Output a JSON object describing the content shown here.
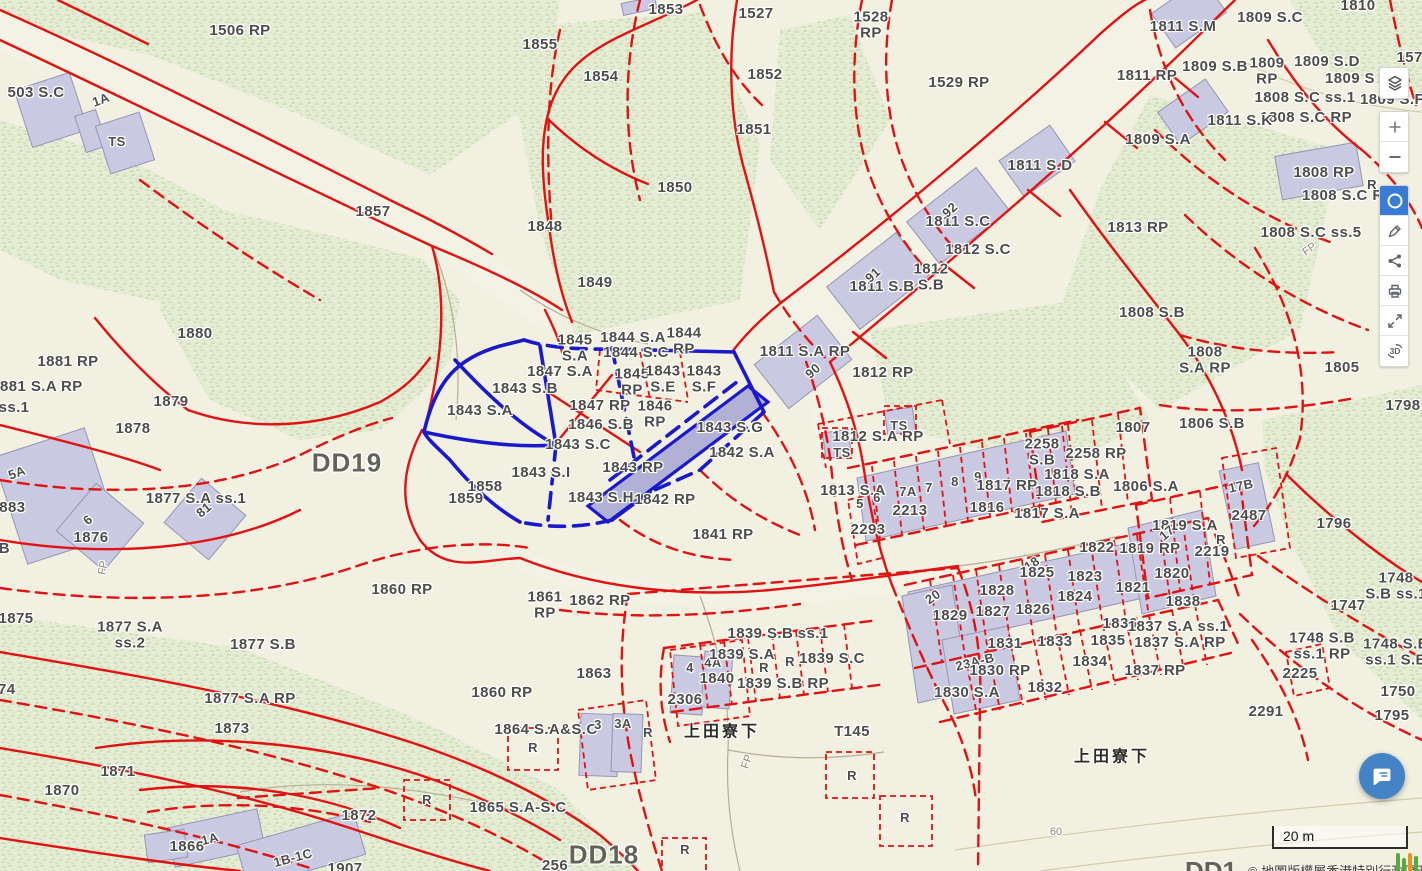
{
  "app": {
    "type": "cadastral-map-viewer"
  },
  "colors": {
    "boundary_red": "#e11212",
    "highlight_blue": "#1a1acb",
    "building_fill": "#c9c9e2",
    "vegetation": "#e6edd6",
    "background": "#f2f0e1",
    "active_tool": "#3a7bd5",
    "chat_fab": "#4484c6"
  },
  "toolbar": {
    "buttons": [
      {
        "name": "layers",
        "icon": "layers-icon",
        "active": false
      },
      {
        "name": "zoom-in",
        "icon": "plus-icon",
        "active": false
      },
      {
        "name": "zoom-out",
        "icon": "minus-icon",
        "active": false
      },
      {
        "name": "circle-select",
        "icon": "circle-icon",
        "active": true
      },
      {
        "name": "measure",
        "icon": "pencil-icon",
        "active": false
      },
      {
        "name": "share",
        "icon": "share-icon",
        "active": false
      },
      {
        "name": "print",
        "icon": "printer-icon",
        "active": false
      },
      {
        "name": "fullscreen",
        "icon": "expand-icon",
        "active": false
      },
      {
        "name": "3d-view",
        "icon": "3d-icon",
        "active": false
      }
    ],
    "threed_glyph": "3D"
  },
  "scalebar": {
    "label": "20 m"
  },
  "attribution": {
    "partial_label": "DD1",
    "text": "© 地圖版權屬香港特別行政區政府"
  },
  "map": {
    "labels": [
      {
        "t": "1506 RP",
        "x": 240,
        "y": 31
      },
      {
        "t": "503 S.C",
        "x": 36,
        "y": 93
      },
      {
        "t": "1A",
        "x": 101,
        "y": 100,
        "c": "sm",
        "r": -20
      },
      {
        "t": "TS",
        "x": 117,
        "y": 142,
        "c": "sm"
      },
      {
        "t": "1855",
        "x": 540,
        "y": 45
      },
      {
        "t": "1854",
        "x": 601,
        "y": 77
      },
      {
        "t": "1853",
        "x": 666,
        "y": 10
      },
      {
        "t": "1527",
        "x": 756,
        "y": 14
      },
      {
        "t": "1852",
        "x": 765,
        "y": 75
      },
      {
        "t": "1851",
        "x": 754,
        "y": 130
      },
      {
        "t": "1529 RP",
        "x": 959,
        "y": 83
      },
      {
        "t": "1528\nRP",
        "x": 871,
        "y": 25
      },
      {
        "t": "1850",
        "x": 675,
        "y": 188
      },
      {
        "t": "1857",
        "x": 373,
        "y": 212
      },
      {
        "t": "1848",
        "x": 545,
        "y": 227
      },
      {
        "t": "1849",
        "x": 595,
        "y": 283
      },
      {
        "t": "1810",
        "x": 1358,
        "y": 6
      },
      {
        "t": "1811 S.M",
        "x": 1183,
        "y": 27
      },
      {
        "t": "1809 S.C",
        "x": 1270,
        "y": 18
      },
      {
        "t": "1809 S.B",
        "x": 1215,
        "y": 67
      },
      {
        "t": "1809\nRP",
        "x": 1267,
        "y": 71
      },
      {
        "t": "1809 S.D",
        "x": 1327,
        "y": 62
      },
      {
        "t": "1574",
        "x": 1414,
        "y": 58
      },
      {
        "t": "1809 S",
        "x": 1350,
        "y": 79
      },
      {
        "t": "1808 S.C ss.1",
        "x": 1305,
        "y": 98
      },
      {
        "t": "1809 S.F",
        "x": 1392,
        "y": 100
      },
      {
        "t": "1808 S.C RP",
        "x": 1306,
        "y": 118
      },
      {
        "t": "1811 RP",
        "x": 1147,
        "y": 76
      },
      {
        "t": "1811 S.K",
        "x": 1240,
        "y": 121
      },
      {
        "t": "1809 S.A",
        "x": 1158,
        "y": 140
      },
      {
        "t": "1811 S.D",
        "x": 1040,
        "y": 166
      },
      {
        "t": "1813 RP",
        "x": 1138,
        "y": 228
      },
      {
        "t": "1808 RP",
        "x": 1324,
        "y": 173
      },
      {
        "t": "1808 S.C RP",
        "x": 1348,
        "y": 196
      },
      {
        "t": "1808 S.C ss.5",
        "x": 1311,
        "y": 233
      },
      {
        "t": "1808 S.B",
        "x": 1152,
        "y": 313
      },
      {
        "t": "1805",
        "x": 1342,
        "y": 368
      },
      {
        "t": "1808\nS.A RP",
        "x": 1205,
        "y": 360
      },
      {
        "t": "1798",
        "x": 1403,
        "y": 406
      },
      {
        "t": "1811 S.C",
        "x": 958,
        "y": 222
      },
      {
        "t": "92",
        "x": 950,
        "y": 210,
        "c": "sm",
        "r": -42
      },
      {
        "t": "1812 S.C",
        "x": 978,
        "y": 250
      },
      {
        "t": "1812\nS.B",
        "x": 931,
        "y": 277
      },
      {
        "t": "1811 S.B",
        "x": 882,
        "y": 287
      },
      {
        "t": "91",
        "x": 873,
        "y": 275,
        "c": "sm",
        "r": -42
      },
      {
        "t": "1811 S.A RP",
        "x": 805,
        "y": 352
      },
      {
        "t": "90",
        "x": 813,
        "y": 371,
        "c": "sm",
        "r": -42
      },
      {
        "t": "1812 RP",
        "x": 883,
        "y": 373
      },
      {
        "t": "1880",
        "x": 195,
        "y": 334
      },
      {
        "t": "1881 RP",
        "x": 68,
        "y": 362
      },
      {
        "t": "1881 S.A RP",
        "x": 37,
        "y": 387
      },
      {
        "t": "ss.1",
        "x": 14,
        "y": 408
      },
      {
        "t": "1879",
        "x": 171,
        "y": 402
      },
      {
        "t": "1878",
        "x": 133,
        "y": 429
      },
      {
        "t": "DD19",
        "x": 347,
        "y": 463,
        "c": "district"
      },
      {
        "t": "1859",
        "x": 466,
        "y": 499
      },
      {
        "t": "1858",
        "x": 485,
        "y": 487
      },
      {
        "t": "1843 S.A",
        "x": 480,
        "y": 411
      },
      {
        "t": "1845\nS.A",
        "x": 575,
        "y": 348
      },
      {
        "t": "1844 S.A",
        "x": 633,
        "y": 338
      },
      {
        "t": "1844\nRP",
        "x": 684,
        "y": 341
      },
      {
        "t": "1844 S.C",
        "x": 636,
        "y": 353
      },
      {
        "t": "1847 S.A",
        "x": 560,
        "y": 372
      },
      {
        "t": "1843 S.B",
        "x": 525,
        "y": 389
      },
      {
        "t": "1845\nRP",
        "x": 632,
        "y": 382
      },
      {
        "t": "1843\nS.E",
        "x": 663,
        "y": 379
      },
      {
        "t": "1843\nS.F",
        "x": 704,
        "y": 379
      },
      {
        "t": "1847 RP",
        "x": 600,
        "y": 406
      },
      {
        "t": "1846\nRP",
        "x": 655,
        "y": 414
      },
      {
        "t": "1846 S.B",
        "x": 601,
        "y": 425
      },
      {
        "t": "1843 S.G",
        "x": 730,
        "y": 428
      },
      {
        "t": "1843 S.C",
        "x": 578,
        "y": 445
      },
      {
        "t": "1842 S.A",
        "x": 742,
        "y": 453
      },
      {
        "t": "1843 S.I",
        "x": 541,
        "y": 473
      },
      {
        "t": "1843 RP",
        "x": 633,
        "y": 468
      },
      {
        "t": "1843 S.H",
        "x": 601,
        "y": 498
      },
      {
        "t": "1842 RP",
        "x": 665,
        "y": 500
      },
      {
        "t": "1841 RP",
        "x": 723,
        "y": 535
      },
      {
        "t": "5A",
        "x": 17,
        "y": 473,
        "c": "sm",
        "r": -20
      },
      {
        "t": "1883",
        "x": 8,
        "y": 508
      },
      {
        "t": "6",
        "x": 88,
        "y": 520,
        "c": "sm",
        "r": -40
      },
      {
        "t": "1876",
        "x": 91,
        "y": 538
      },
      {
        "t": "1877 S.A ss.1",
        "x": 196,
        "y": 499
      },
      {
        "t": "81",
        "x": 204,
        "y": 510,
        "c": "sm",
        "r": -40
      },
      {
        "t": "6B",
        "x": 0,
        "y": 549
      },
      {
        "t": "1875",
        "x": 16,
        "y": 619
      },
      {
        "t": "1877 S.A\nss.2",
        "x": 130,
        "y": 635
      },
      {
        "t": "1877 S.B",
        "x": 263,
        "y": 645
      },
      {
        "t": "1874",
        "x": -2,
        "y": 690
      },
      {
        "t": "1877 S.A RP",
        "x": 250,
        "y": 699
      },
      {
        "t": "1873",
        "x": 232,
        "y": 729
      },
      {
        "t": "1860 RP",
        "x": 402,
        "y": 590
      },
      {
        "t": "1861\nRP",
        "x": 545,
        "y": 605
      },
      {
        "t": "1862 RP",
        "x": 600,
        "y": 601
      },
      {
        "t": "1863",
        "x": 594,
        "y": 674
      },
      {
        "t": "1860 RP",
        "x": 502,
        "y": 693
      },
      {
        "t": "1864 S.A&S.C",
        "x": 546,
        "y": 730
      },
      {
        "t": "R",
        "x": 533,
        "y": 748,
        "c": "sm"
      },
      {
        "t": "3",
        "x": 598,
        "y": 725,
        "c": "sm"
      },
      {
        "t": "3A",
        "x": 623,
        "y": 724,
        "c": "sm"
      },
      {
        "t": "R",
        "x": 648,
        "y": 733,
        "c": "sm"
      },
      {
        "t": "2306",
        "x": 685,
        "y": 700
      },
      {
        "t": "4",
        "x": 690,
        "y": 668,
        "c": "sm"
      },
      {
        "t": "4A",
        "x": 713,
        "y": 663,
        "c": "sm"
      },
      {
        "t": "1840",
        "x": 717,
        "y": 679
      },
      {
        "t": "1839 S.A",
        "x": 742,
        "y": 655
      },
      {
        "t": "R",
        "x": 764,
        "y": 668,
        "c": "sm"
      },
      {
        "t": "R",
        "x": 790,
        "y": 662,
        "c": "sm"
      },
      {
        "t": "1839 S.C",
        "x": 832,
        "y": 659
      },
      {
        "t": "1839 S.B ss.1",
        "x": 778,
        "y": 634
      },
      {
        "t": "1839 S.B RP",
        "x": 783,
        "y": 684
      },
      {
        "t": "上田寮下",
        "x": 722,
        "y": 733,
        "c": "place"
      },
      {
        "t": "T145",
        "x": 852,
        "y": 732
      },
      {
        "t": "R",
        "x": 427,
        "y": 800,
        "c": "sm"
      },
      {
        "t": "1865 S.A-S.C",
        "x": 518,
        "y": 808
      },
      {
        "t": "DD18",
        "x": 604,
        "y": 855,
        "c": "district"
      },
      {
        "t": "256",
        "x": 555,
        "y": 866
      },
      {
        "t": "1871",
        "x": 118,
        "y": 772
      },
      {
        "t": "1870",
        "x": 62,
        "y": 791
      },
      {
        "t": "1872",
        "x": 359,
        "y": 816
      },
      {
        "t": "1866",
        "x": 187,
        "y": 847
      },
      {
        "t": "1A",
        "x": 210,
        "y": 839,
        "c": "sm",
        "r": -15
      },
      {
        "t": "1B-1C",
        "x": 293,
        "y": 858,
        "c": "sm",
        "r": -15
      },
      {
        "t": "1907",
        "x": 345,
        "y": 869
      },
      {
        "t": "TS",
        "x": 899,
        "y": 426,
        "c": "sm"
      },
      {
        "t": "TS",
        "x": 842,
        "y": 453,
        "c": "sm"
      },
      {
        "t": "1812 S.A RP",
        "x": 878,
        "y": 437
      },
      {
        "t": "2258\nS.B",
        "x": 1042,
        "y": 452
      },
      {
        "t": "2258 RP",
        "x": 1096,
        "y": 454
      },
      {
        "t": "1818 S.A",
        "x": 1077,
        "y": 475
      },
      {
        "t": "1818 S.B",
        "x": 1068,
        "y": 492
      },
      {
        "t": "1806 S.A",
        "x": 1146,
        "y": 487
      },
      {
        "t": "1807",
        "x": 1133,
        "y": 428
      },
      {
        "t": "1806 S.B",
        "x": 1212,
        "y": 424
      },
      {
        "t": "17B",
        "x": 1241,
        "y": 486,
        "c": "sm",
        "r": -12
      },
      {
        "t": "2487",
        "x": 1249,
        "y": 516
      },
      {
        "t": "1796",
        "x": 1334,
        "y": 524
      },
      {
        "t": "1813 S.A",
        "x": 853,
        "y": 491
      },
      {
        "t": "5",
        "x": 860,
        "y": 504,
        "c": "sm"
      },
      {
        "t": "6",
        "x": 877,
        "y": 498,
        "c": "sm"
      },
      {
        "t": "7A",
        "x": 908,
        "y": 492,
        "c": "sm"
      },
      {
        "t": "7",
        "x": 929,
        "y": 488,
        "c": "sm"
      },
      {
        "t": "8",
        "x": 955,
        "y": 482,
        "c": "sm"
      },
      {
        "t": "9",
        "x": 978,
        "y": 477,
        "c": "sm"
      },
      {
        "t": "1817 RP",
        "x": 1007,
        "y": 486
      },
      {
        "t": "2213",
        "x": 910,
        "y": 511
      },
      {
        "t": "1816",
        "x": 987,
        "y": 508
      },
      {
        "t": "1817 S.A",
        "x": 1047,
        "y": 514
      },
      {
        "t": "2293",
        "x": 868,
        "y": 530
      },
      {
        "t": "1819 S.A",
        "x": 1185,
        "y": 526
      },
      {
        "t": "17",
        "x": 1167,
        "y": 533,
        "c": "sm",
        "r": -40
      },
      {
        "t": "1819 RP",
        "x": 1150,
        "y": 549
      },
      {
        "t": "2219",
        "x": 1212,
        "y": 552
      },
      {
        "t": "R",
        "x": 1221,
        "y": 540,
        "c": "sm"
      },
      {
        "t": "1820",
        "x": 1172,
        "y": 574
      },
      {
        "t": "1822",
        "x": 1097,
        "y": 548
      },
      {
        "t": "18",
        "x": 1032,
        "y": 564,
        "c": "sm",
        "r": -35
      },
      {
        "t": "1825",
        "x": 1037,
        "y": 573
      },
      {
        "t": "1823",
        "x": 1085,
        "y": 577
      },
      {
        "t": "1828",
        "x": 997,
        "y": 591
      },
      {
        "t": "1821",
        "x": 1133,
        "y": 588
      },
      {
        "t": "1824",
        "x": 1075,
        "y": 597
      },
      {
        "t": "20",
        "x": 933,
        "y": 597,
        "c": "sm",
        "r": -35
      },
      {
        "t": "1829",
        "x": 950,
        "y": 616
      },
      {
        "t": "1827",
        "x": 993,
        "y": 612
      },
      {
        "t": "1826",
        "x": 1033,
        "y": 610
      },
      {
        "t": "1838",
        "x": 1183,
        "y": 602
      },
      {
        "t": "1836",
        "x": 1120,
        "y": 624
      },
      {
        "t": "1837 S.A ss.1",
        "x": 1178,
        "y": 627
      },
      {
        "t": "1837 S.A RP",
        "x": 1180,
        "y": 643
      },
      {
        "t": "1831",
        "x": 1005,
        "y": 644
      },
      {
        "t": "1833",
        "x": 1055,
        "y": 642
      },
      {
        "t": "1835",
        "x": 1108,
        "y": 641
      },
      {
        "t": "23A-B",
        "x": 975,
        "y": 662,
        "c": "sm",
        "r": -14
      },
      {
        "t": "1830 RP",
        "x": 1000,
        "y": 671
      },
      {
        "t": "1834",
        "x": 1090,
        "y": 662
      },
      {
        "t": "1837 RP",
        "x": 1155,
        "y": 671
      },
      {
        "t": "1830 S.A",
        "x": 967,
        "y": 693
      },
      {
        "t": "1832",
        "x": 1045,
        "y": 688
      },
      {
        "t": "上田寮下",
        "x": 1112,
        "y": 758,
        "c": "place"
      },
      {
        "t": "1748\nS.B ss.1",
        "x": 1396,
        "y": 586
      },
      {
        "t": "1747",
        "x": 1348,
        "y": 606
      },
      {
        "t": "1748 S.B\nss.1 RP",
        "x": 1322,
        "y": 646
      },
      {
        "t": "1748 S.B\nss.1 S.B",
        "x": 1396,
        "y": 652
      },
      {
        "t": "2225",
        "x": 1300,
        "y": 674
      },
      {
        "t": "2291",
        "x": 1266,
        "y": 712
      },
      {
        "t": "1750",
        "x": 1398,
        "y": 692
      },
      {
        "t": "1795",
        "x": 1392,
        "y": 716
      },
      {
        "t": "60",
        "x": 1056,
        "y": 833,
        "c": "tiny"
      },
      {
        "t": "60",
        "x": 1308,
        "y": 838,
        "c": "tiny"
      },
      {
        "t": "FP",
        "x": 748,
        "y": 762,
        "c": "tiny",
        "r": -70
      },
      {
        "t": "FP",
        "x": 1310,
        "y": 250,
        "c": "tiny",
        "r": -35
      },
      {
        "t": "FP",
        "x": 104,
        "y": 568,
        "c": "tiny",
        "r": -80
      },
      {
        "t": "R",
        "x": 852,
        "y": 776,
        "c": "sm"
      },
      {
        "t": "R",
        "x": 905,
        "y": 818,
        "c": "sm"
      },
      {
        "t": "R",
        "x": 685,
        "y": 850,
        "c": "sm"
      },
      {
        "t": "R",
        "x": 1372,
        "y": 185,
        "c": "sm"
      }
    ]
  }
}
